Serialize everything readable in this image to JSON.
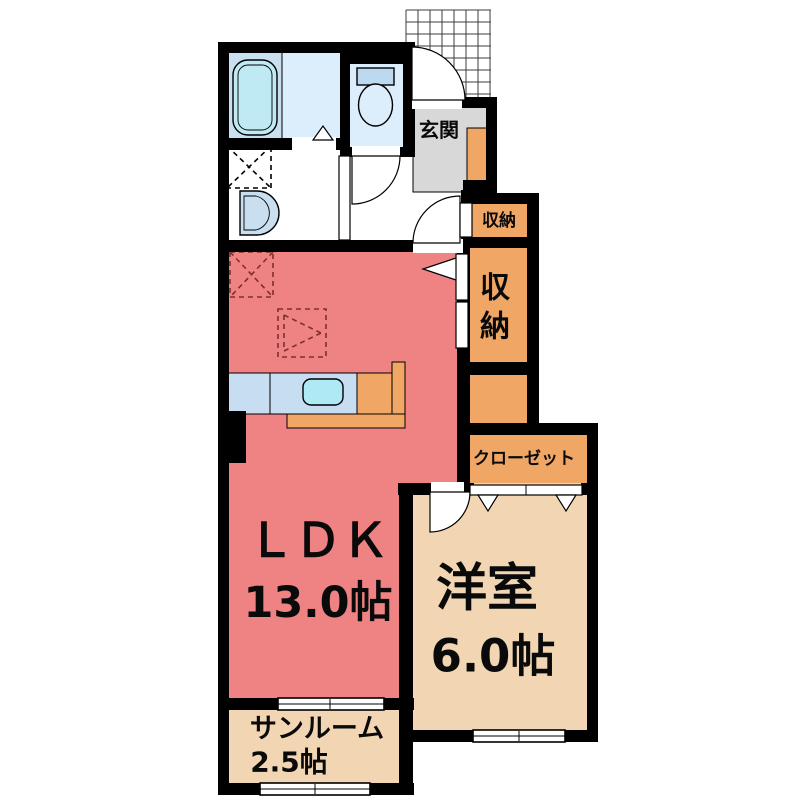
{
  "rooms": {
    "entrance": {
      "label": "玄関"
    },
    "hall_storage": {
      "label": "収納"
    },
    "main_storage": {
      "chars": [
        "収",
        "納"
      ]
    },
    "closet": {
      "label": "クローゼット"
    },
    "ldk": {
      "label": "ＬＤＫ",
      "size": "13.0帖"
    },
    "western_room": {
      "label": "洋室",
      "size": "6.0帖"
    },
    "sunroom": {
      "label": "サンルーム",
      "size": "2.5帖"
    }
  },
  "colors": {
    "wall": "#000000",
    "ldk_pink": "#EF8282",
    "room_beige": "#F2D5B2",
    "storage_orange": "#F0A765",
    "entrance_gray": "#D8D8D8",
    "bath_blue": "#DCEDFB",
    "bath_blue_dark": "#C9DFF0",
    "tub_cyan": "#BFE9F3",
    "sink_cyan": "#AEE9F5",
    "counter_blue": "#C7DDF1",
    "fixture_blue": "#BCD9F0",
    "equip_dash_red": "#7E2F2F"
  }
}
